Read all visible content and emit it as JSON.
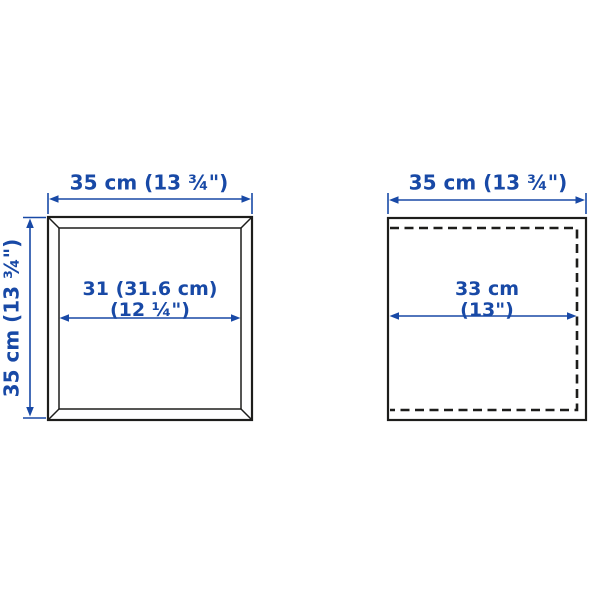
{
  "diagram_title": "cabinet dimension diagram",
  "left_cabinet": {
    "description": "front view of framed cube cabinet with mitred corners",
    "width_label": "35 cm (13 ¾\")",
    "height_label": "35 cm (13 ¾\")",
    "inner_width_line1": "31 (31.6 cm)",
    "inner_width_line2": "(12 ¼\")"
  },
  "right_cabinet": {
    "description": "side view of cabinet with dashed inner depth line",
    "width_label": "35 cm (13 ¾\")",
    "inner_depth_line1": "33 cm",
    "inner_depth_line2": "(13\")"
  },
  "colors": {
    "dimension_blue": "#1849a6",
    "outline_black": "#1d1d1b",
    "background": "#ffffff"
  }
}
